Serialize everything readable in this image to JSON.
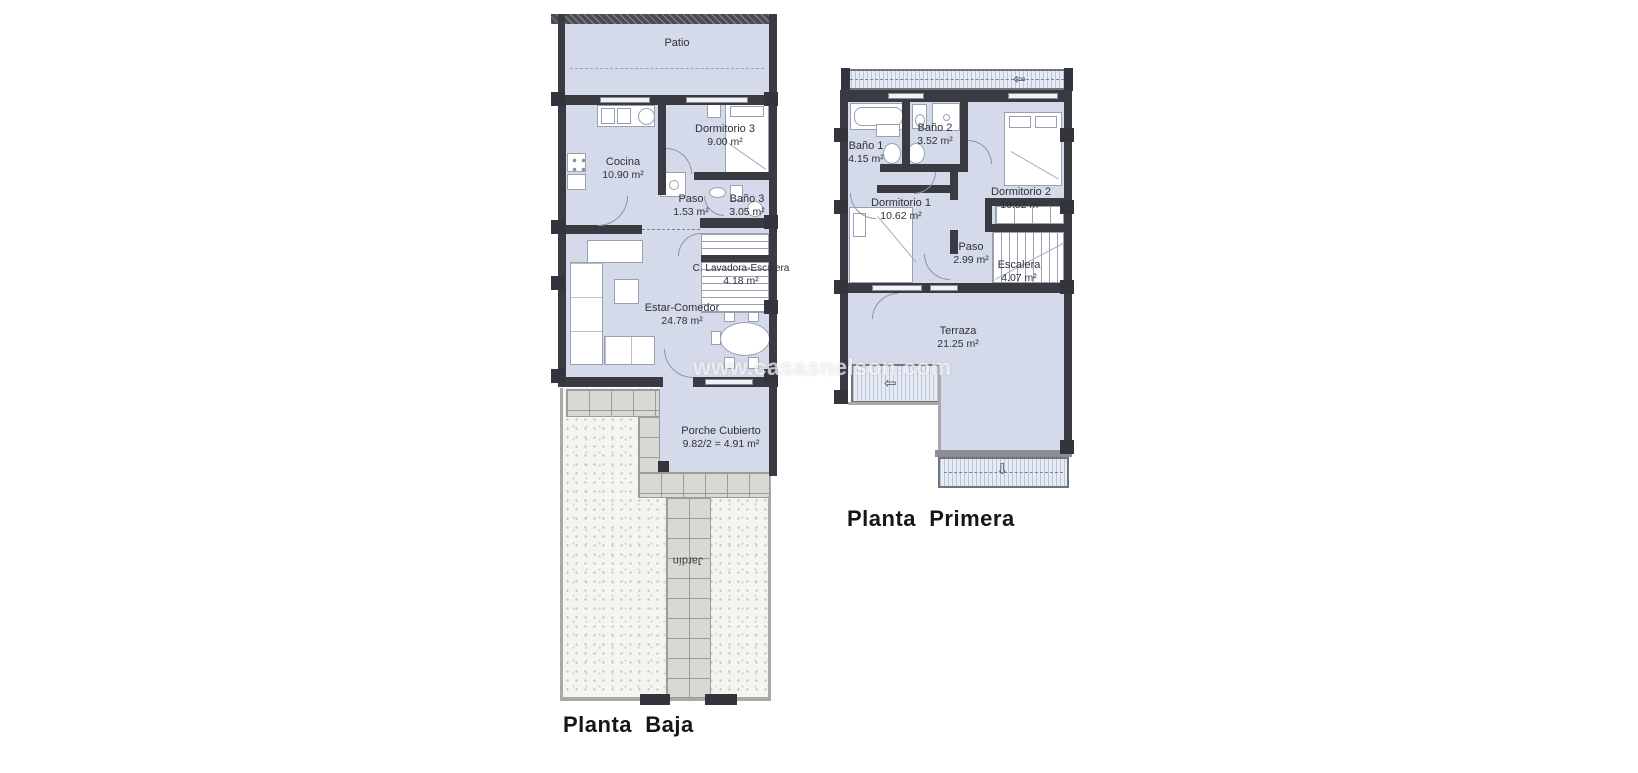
{
  "watermark": {
    "text": "www.casasnelson.com"
  },
  "icons": {
    "roof_arrow_left": "⇦",
    "roof_arrow_down": "⇩"
  },
  "colors": {
    "room_fill": "#d5daea",
    "wall_dark": "#3a3a42",
    "roof_hatch": "#e7ebf4",
    "garden": "#f5f4ee",
    "tile": "#d8d8d4",
    "label_text": "#2d3038"
  },
  "ground_floor": {
    "title": "Planta  Baja",
    "rooms": {
      "patio": {
        "name": "Patio",
        "area": ""
      },
      "cocina": {
        "name": "Cocina",
        "area": "10.90 m²"
      },
      "dormitorio_3": {
        "name": "Dormitorio 3",
        "area": "9.00 m²"
      },
      "paso": {
        "name": "Paso",
        "area": "1.53 m²"
      },
      "bano_3": {
        "name": "Baño 3",
        "area": "3.05 m²"
      },
      "estar_comedor": {
        "name": "Estar-Comedor",
        "area": "24.78 m²"
      },
      "lavadora_escalera": {
        "name": "C. Lavadora-Escalera",
        "area": "4.18 m²"
      },
      "porche": {
        "name": "Porche Cubierto",
        "area": "9.82/2 = 4.91 m²"
      },
      "jardin": {
        "name": "Jardín",
        "area": ""
      }
    }
  },
  "first_floor": {
    "title": "Planta  Primera",
    "rooms": {
      "bano_1": {
        "name": "Baño 1",
        "area": "4.15 m²"
      },
      "bano_2": {
        "name": "Baño 2",
        "area": "3.52 m²"
      },
      "dormitorio_1": {
        "name": "Dormitorio 1",
        "area": "10.62 m²"
      },
      "dormitorio_2": {
        "name": "Dormitorio 2",
        "area": "10.82 m²"
      },
      "paso": {
        "name": "Paso",
        "area": "2.99 m²"
      },
      "escalera": {
        "name": "Escalera",
        "area": "4.07 m²"
      },
      "terraza": {
        "name": "Terraza",
        "area": "21.25 m²"
      }
    }
  }
}
